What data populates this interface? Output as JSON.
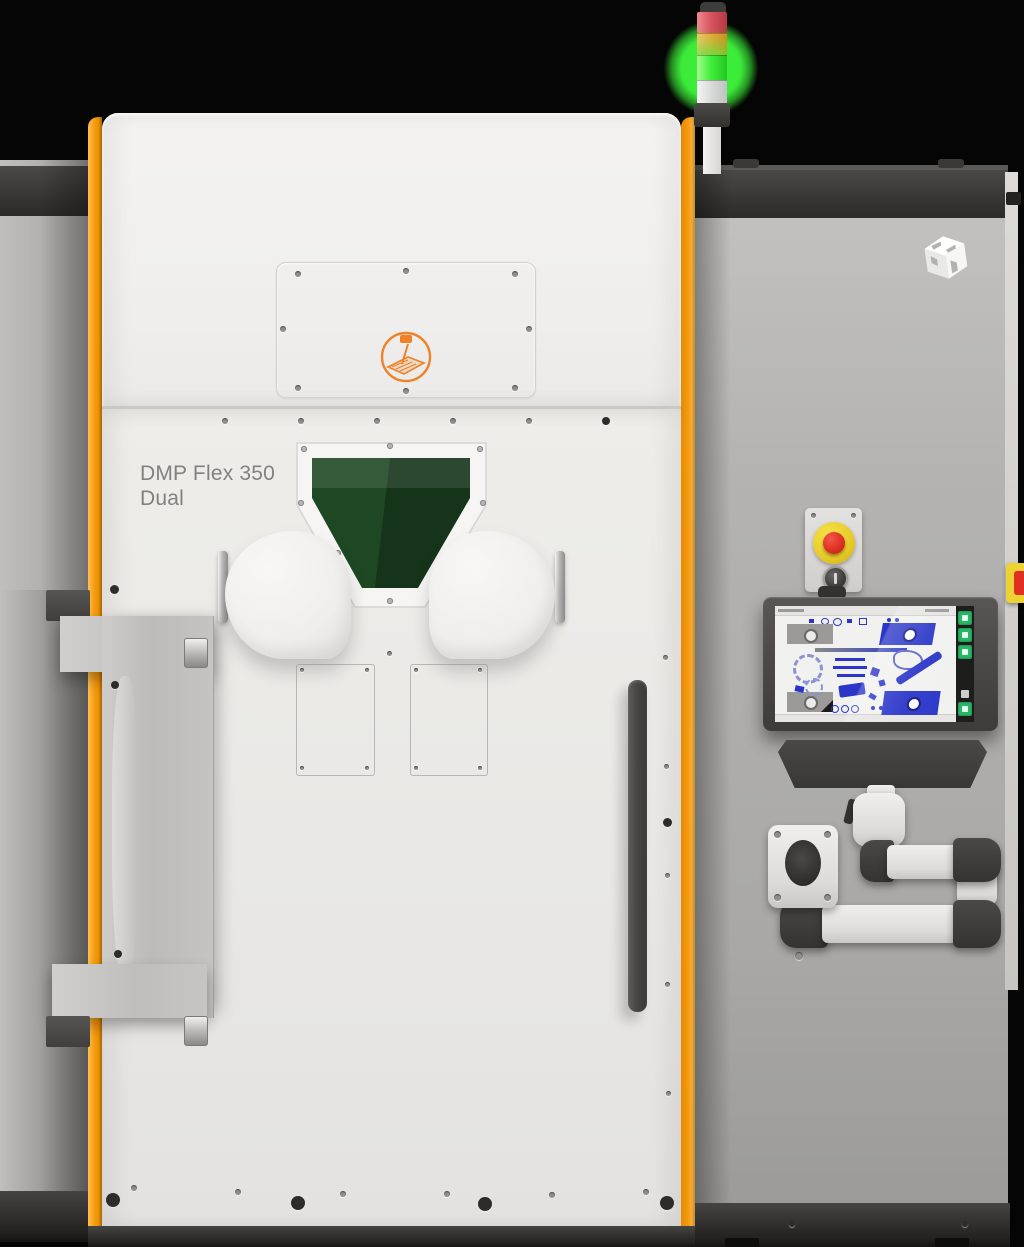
{
  "scene": {
    "type": "product-photo",
    "subject": "metal additive manufacturing printer, front view",
    "model_label": {
      "line1": "DMP Flex 350",
      "line2": "Dual"
    }
  },
  "palette": {
    "background": "#050505",
    "cabinet_white": "#ecebe9",
    "accent_orange": "#f59c12",
    "side_gray": "#b2b1af",
    "dark_band": "#3a3937",
    "base_dark": "#2b2a28",
    "window_green": "#1e4823",
    "estop_red": "#df3023",
    "estop_yellow": "#eed233",
    "tower_red": "#d95560",
    "tower_amber": "#f2a83e",
    "tower_green": "#45ef3c",
    "screen_blue": "#2b36c8",
    "screen_bg": "#f1f1ef"
  },
  "tower_light": {
    "segments": [
      {
        "name": "red",
        "lit": false
      },
      {
        "name": "amber",
        "lit": false
      },
      {
        "name": "green",
        "lit": true
      },
      {
        "name": "clear",
        "lit": false
      }
    ],
    "status": "green-lit"
  },
  "monitor": {
    "content": "build-layout-preview",
    "sidebar_buttons": [
      {
        "icon": "export-icon"
      },
      {
        "icon": "report-icon"
      },
      {
        "icon": "camera-icon"
      },
      {
        "icon": "user-icon"
      }
    ]
  }
}
